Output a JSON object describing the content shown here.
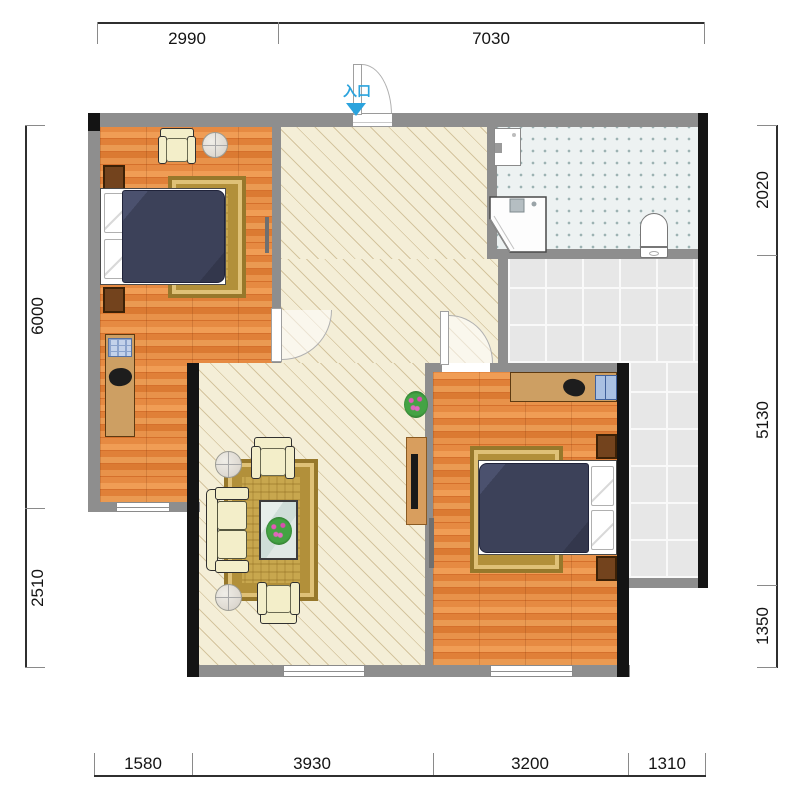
{
  "entry": {
    "label": "入口"
  },
  "dimensions": {
    "top": [
      "2990",
      "7030"
    ],
    "bottom": [
      "1580",
      "3930",
      "3200",
      "1310"
    ],
    "left": [
      "6000",
      "2510"
    ],
    "right": [
      "2020",
      "5130",
      "1350"
    ]
  },
  "colors": {
    "accent_entry": "#2ba3dd",
    "wall": "#8e8e8e",
    "bearing_wall": "#141414",
    "wood_floor": "#e08038",
    "hall_floor": "#f4eed7",
    "balcony_tile": "#e7e7e7",
    "bathroom_floor": "#edf2f2",
    "bed_cover": "#3c4159",
    "rug_gold": "#c8a74e",
    "sofa_cream": "#f3eec9",
    "nightstand_brown": "#73431d",
    "desk_tan": "#cd9f63"
  }
}
